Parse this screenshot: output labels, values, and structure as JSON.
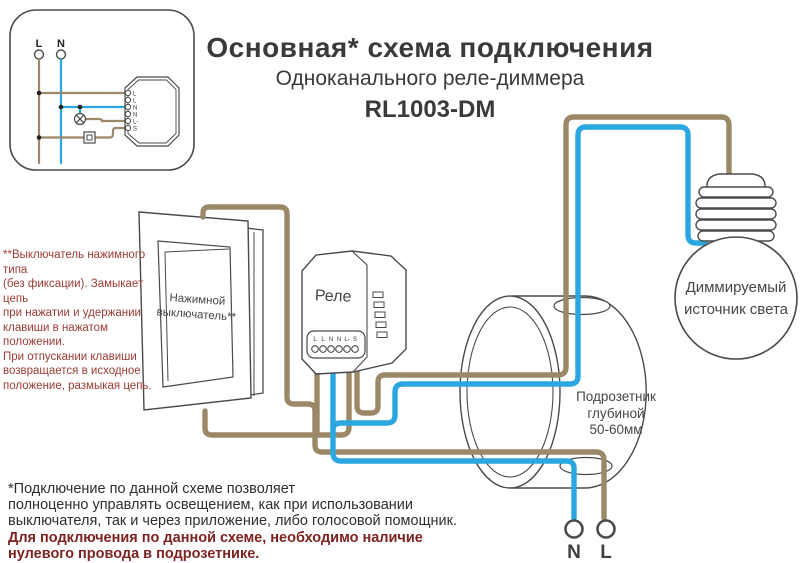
{
  "title": {
    "line1": "Основная* схема подключения",
    "line2": "Одноканального реле-диммера",
    "line3": "RL1003-DM"
  },
  "inset": {
    "live_label": "L",
    "neutral_label": "N",
    "relay_terminals": [
      "L",
      "L",
      "N",
      "N",
      "L-",
      "S"
    ]
  },
  "switch_note": {
    "lines": [
      "**Выключатель нажимного типа",
      "(без фиксации). Замыкает цепь",
      "при нажатии и удержании",
      "клавиши в нажатом положении.",
      "При отпускании клавиши",
      "возвращается в исходное",
      "положение, размыкая цепь."
    ]
  },
  "wall_switch": {
    "label_line1": "Нажимной",
    "label_line2": "выключатель**"
  },
  "relay": {
    "label": "Реле",
    "terminals": [
      "L",
      "L",
      "N",
      "N",
      "L-",
      "S"
    ]
  },
  "mounting_box": {
    "label_line1": "Подрозетник",
    "label_line2": "глубиной",
    "label_line3": "50-60мм"
  },
  "bulb": {
    "label_line1": "Диммируемый",
    "label_line2": "источник света"
  },
  "mains": {
    "neutral_label": "N",
    "live_label": "L"
  },
  "footnote": {
    "black_lines": [
      "*Подключение по данной схеме позволяет",
      "полноценно управлять освещением, как при использовании",
      "выключателя, так и через приложение, либо голосовой помощник."
    ],
    "red_lines": [
      "Для подключения по данной схеме, необходимо наличие",
      "нулевого провода в подрозетнике."
    ]
  },
  "colors": {
    "live_wire": "#9a8867",
    "neutral_wire": "#2aa7e0",
    "outline": "#4a4a4a",
    "note_red": "#9a3b33",
    "footnote_red": "#7c2320",
    "text_dark": "#3a3a3a"
  }
}
